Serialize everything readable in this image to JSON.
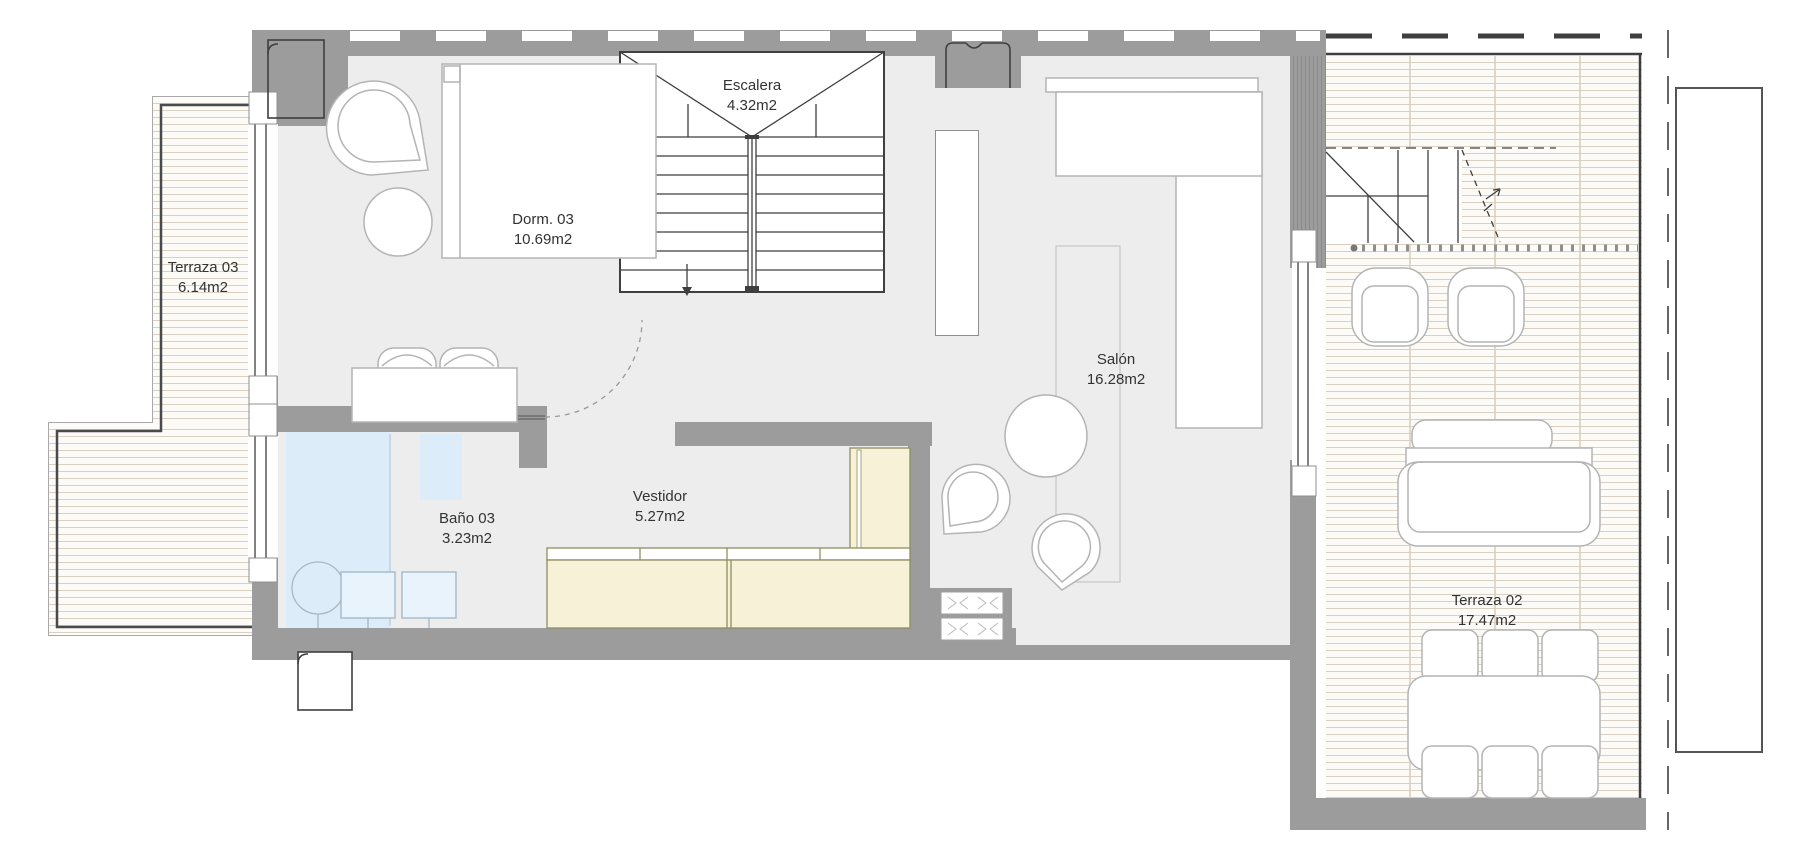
{
  "plan_title": "Floor plan",
  "rooms": {
    "terraza03": {
      "name": "Terraza 03",
      "area": "6.14m2"
    },
    "dorm03": {
      "name": "Dorm. 03",
      "area": "10.69m2"
    },
    "escalera": {
      "name": "Escalera",
      "area": "4.32m2"
    },
    "salon": {
      "name": "Salón",
      "area": "16.28m2"
    },
    "bano03": {
      "name": "Baño 03",
      "area": "3.23m2"
    },
    "vestidor": {
      "name": "Vestidor",
      "area": "5.27m2"
    },
    "terraza02": {
      "name": "Terraza 02",
      "area": "17.47m2"
    }
  },
  "colors": {
    "wall": "#9c9c9c",
    "floor": "#ededee",
    "deck_background": "#fcfbf7",
    "deck_line": "#d9d0c2",
    "bath_blue": "#dcecf8",
    "wardrobe_cream": "#f7f1d8",
    "wardrobe_border": "#8e8e62",
    "dark_line": "#3f3f3f",
    "furniture_line": "#b4b4b4",
    "label_text": "#333333"
  }
}
